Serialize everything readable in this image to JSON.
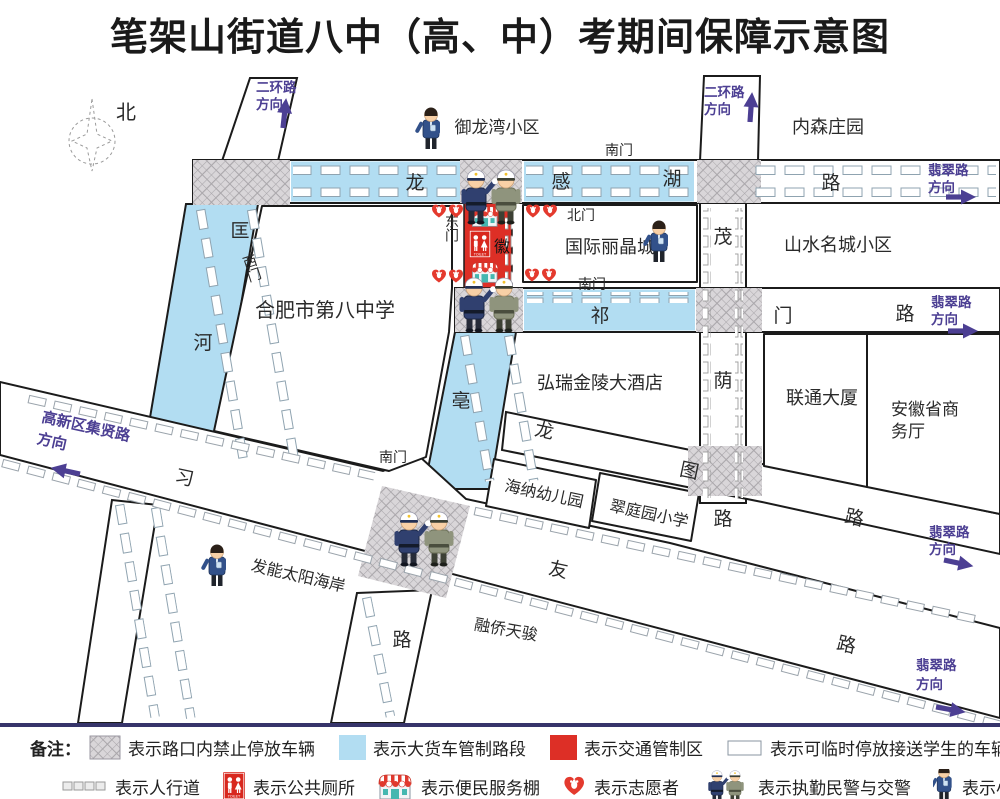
{
  "title": "笔架山街道八中（高、中）考期间保障示意图",
  "map": {
    "compass_north": "北",
    "signs": {
      "erhuan_west": [
        "二环路",
        "方向"
      ],
      "erhuan_east": [
        "二环路",
        "方向"
      ],
      "feicui_top": [
        "翡翠路",
        "方向"
      ],
      "feicui_qimen": [
        "翡翠路",
        "方向"
      ],
      "feicui_longtu": [
        "翡翠路",
        "方向"
      ],
      "feicui_xiyou": [
        "翡翠路",
        "方向"
      ],
      "jixian": [
        "高新区集贤路",
        "方向"
      ]
    },
    "roads": {
      "longganhu": [
        "龙",
        "感",
        "湖",
        "路"
      ],
      "qimen": [
        "祁",
        "门",
        "路"
      ],
      "center": [
        "徽",
        "亳",
        "路"
      ],
      "kuanghe": [
        "匡",
        "河"
      ],
      "maoyin": [
        "茂",
        "荫",
        "路"
      ],
      "longtu": [
        "龙",
        "图",
        "路"
      ],
      "xiyou": [
        "习",
        "友",
        "路"
      ]
    },
    "gates": {
      "south": "南门",
      "north": "北门",
      "east": "东门",
      "west": "西门"
    },
    "places": {
      "yulongwan": "御龙湾小区",
      "neisen": "内森庄园",
      "guoji": "国际丽晶城",
      "shanshui": "山水名城小区",
      "bazhong": "合肥市第八中学",
      "hongrui": "弘瑞金陵大酒店",
      "liantong": "联通大厦",
      "shangwu": [
        "安徽省商",
        "务厅"
      ],
      "haina": "海纳幼儿园",
      "cuiting": "翠庭园小学",
      "faneng": "发能太阳海岸",
      "rongqiao": "融侨天骏"
    },
    "toilet_text": "TOILET"
  },
  "legend": {
    "label": "备注：",
    "row1": [
      {
        "swatch": "hatch",
        "text": "表示路口内禁止停放车辆"
      },
      {
        "swatch": "blue",
        "text": "表示大货车管制路段"
      },
      {
        "swatch": "red",
        "text": "表示交通管制区"
      },
      {
        "swatch": "white",
        "text": "表示可临时停放接送学生的车辆 禁止双排停放"
      }
    ],
    "row2": [
      {
        "icon": "sidewalk-icon",
        "text": "表示人行道"
      },
      {
        "icon": "toilet-icon",
        "text": "表示公共厕所"
      },
      {
        "icon": "shed-icon",
        "text": "表示便民服务棚"
      },
      {
        "icon": "heart-icon",
        "text": "表示志愿者"
      },
      {
        "icon": "police-icon",
        "text": "表示执勤民警与交警"
      },
      {
        "icon": "worker-icon",
        "text": "表示小区网格长"
      }
    ]
  },
  "colors": {
    "truck_control_blue": "#b2ddf2",
    "traffic_control_red": "#dd2f26",
    "direction_purple": "#4c3f93",
    "no_parking_hatch": "#d9d6d9",
    "divider_navy": "#36346a"
  }
}
